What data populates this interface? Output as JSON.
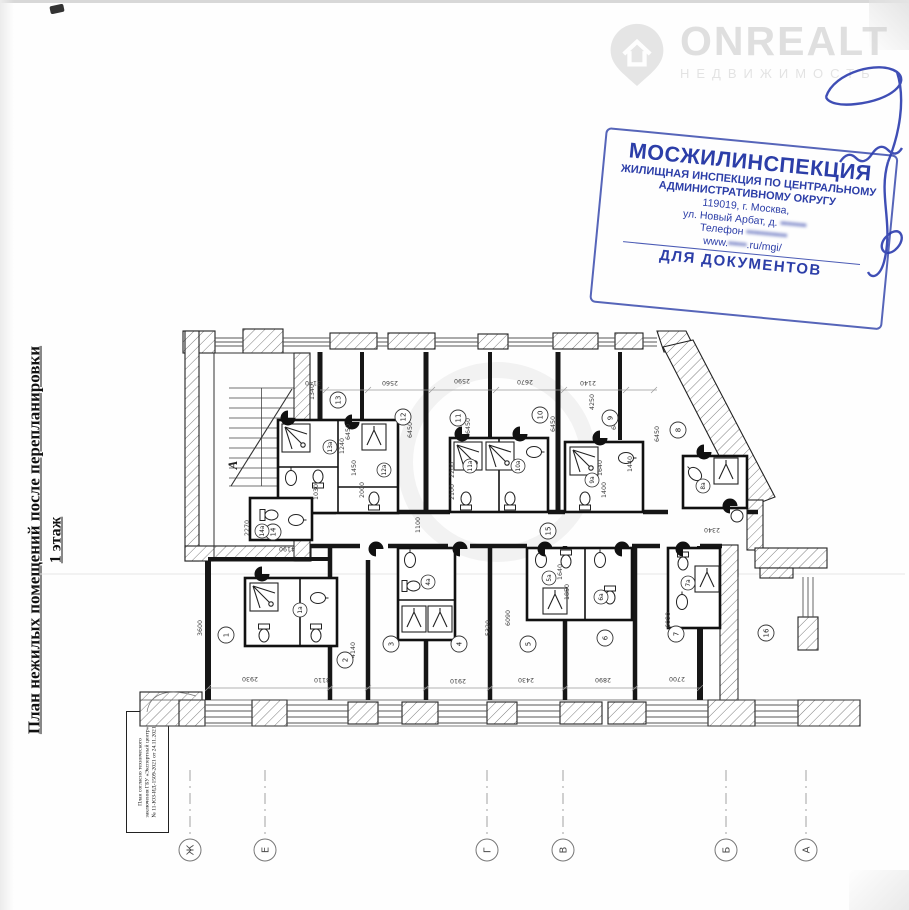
{
  "watermark": {
    "brand": "ONREALT",
    "subtitle": "НЕДВИЖИМОСТЬ"
  },
  "stamp": {
    "color": "#2c3ea8",
    "org": "МОСЖИЛИНСПЕКЦИЯ",
    "line1": "ЖИЛИЩНАЯ ИНСПЕКЦИЯ ПО ЦЕНТРАЛЬНОМУ",
    "line2": "АДМИНИСТРАТИВНОМУ ОКРУГУ",
    "addr1": "119019, г. Москва,",
    "addr2_label": "ул. Новый Арбат, д. ",
    "addr2_blur": "▪▪▪▪▪▪▪",
    "addr3_label": "Телефон",
    "addr3_blur": " ▪▪▪▪▪▪▪▪▪▪▪",
    "addr4_pre": "www.",
    "addr4_blur": "▪▪▪▪▪",
    "addr4_post": ".ru/mgi/",
    "footer": "ДЛЯ ДОКУМЕНТОВ"
  },
  "side_caption": {
    "title": "План нежилых помещений после перепланировки",
    "subtitle": "1 этаж"
  },
  "note_box": {
    "line1": "План согласно технического",
    "line2": "заключения ГБУ «Экспертный центр»",
    "line3": "№ 11-ЮЗ-ИД-1509-2021 от 24.11.2021"
  },
  "plan": {
    "stair_label": "А",
    "rooms": [
      {
        "n": "13",
        "x": 338,
        "y": 400
      },
      {
        "n": "12",
        "x": 403,
        "y": 417
      },
      {
        "n": "11",
        "x": 458,
        "y": 418
      },
      {
        "n": "10",
        "x": 540,
        "y": 415
      },
      {
        "n": "9",
        "x": 610,
        "y": 418
      },
      {
        "n": "8",
        "x": 678,
        "y": 430
      },
      {
        "n": "14",
        "x": 273,
        "y": 532
      },
      {
        "n": "15",
        "x": 548,
        "y": 531
      },
      {
        "n": "1",
        "x": 226,
        "y": 635
      },
      {
        "n": "2",
        "x": 345,
        "y": 660
      },
      {
        "n": "3",
        "x": 391,
        "y": 644
      },
      {
        "n": "4",
        "x": 459,
        "y": 644
      },
      {
        "n": "5",
        "x": 528,
        "y": 644
      },
      {
        "n": "6",
        "x": 605,
        "y": 638
      },
      {
        "n": "7",
        "x": 676,
        "y": 634
      },
      {
        "n": "16",
        "x": 766,
        "y": 633
      }
    ],
    "bath_rooms": [
      {
        "n": "13а",
        "x": 330,
        "y": 447
      },
      {
        "n": "12а",
        "x": 384,
        "y": 470
      },
      {
        "n": "14а",
        "x": 262,
        "y": 531
      },
      {
        "n": "11а",
        "x": 470,
        "y": 466
      },
      {
        "n": "10а",
        "x": 518,
        "y": 466
      },
      {
        "n": "9а",
        "x": 592,
        "y": 480
      },
      {
        "n": "8а",
        "x": 703,
        "y": 486
      },
      {
        "n": "1а",
        "x": 300,
        "y": 610
      },
      {
        "n": "4а",
        "x": 428,
        "y": 582
      },
      {
        "n": "5а",
        "x": 549,
        "y": 578
      },
      {
        "n": "6а",
        "x": 601,
        "y": 597
      },
      {
        "n": "7а",
        "x": 688,
        "y": 583
      }
    ],
    "dims": [
      [
        "3140",
        313,
        383,
        180
      ],
      [
        "2560",
        390,
        383,
        180
      ],
      [
        "2590",
        462,
        381,
        180
      ],
      [
        "2670",
        525,
        382,
        180
      ],
      [
        "2140",
        588,
        383,
        180
      ],
      [
        "1340",
        312,
        392,
        -90
      ],
      [
        "6450",
        348,
        432,
        -90
      ],
      [
        "6450",
        410,
        430,
        -90
      ],
      [
        "6450",
        468,
        426,
        -90
      ],
      [
        "6450",
        553,
        424,
        -90
      ],
      [
        "6450",
        614,
        422,
        -90
      ],
      [
        "6450",
        657,
        434,
        -90
      ],
      [
        "4250",
        592,
        402,
        -90
      ],
      [
        "1440",
        630,
        464,
        -90
      ],
      [
        "2270",
        247,
        528,
        -90
      ],
      [
        "4190",
        287,
        549,
        180
      ],
      [
        "1100",
        418,
        525,
        -90
      ],
      [
        "2340",
        712,
        530,
        180
      ],
      [
        "3600",
        200,
        628,
        -90
      ],
      [
        "4140",
        353,
        650,
        -90
      ],
      [
        "5320",
        488,
        628,
        -90
      ],
      [
        "6090",
        508,
        618,
        -90
      ],
      [
        "6090",
        668,
        620,
        -90
      ],
      [
        "2930",
        250,
        679,
        180
      ],
      [
        "3110",
        322,
        680,
        180
      ],
      [
        "2910",
        458,
        681,
        180
      ],
      [
        "2430",
        526,
        680,
        180
      ],
      [
        "2890",
        603,
        680,
        180
      ],
      [
        "2700",
        677,
        679,
        180
      ],
      [
        "1240",
        342,
        446,
        -90
      ],
      [
        "1450",
        354,
        468,
        -90
      ],
      [
        "2000",
        362,
        490,
        -90
      ],
      [
        "1030",
        316,
        492,
        -90
      ],
      [
        "2200",
        452,
        470,
        -90
      ],
      [
        "2100",
        452,
        492,
        -90
      ],
      [
        "1640",
        600,
        468,
        -90
      ],
      [
        "1400",
        604,
        490,
        -90
      ],
      [
        "1640",
        560,
        572,
        -90
      ],
      [
        "1850",
        567,
        592,
        -90
      ]
    ],
    "axes": [
      {
        "l": "Ж",
        "x": 190
      },
      {
        "l": "Е",
        "x": 265
      },
      {
        "l": "Г",
        "x": 487
      },
      {
        "l": "В",
        "x": 563
      },
      {
        "l": "Б",
        "x": 726
      },
      {
        "l": "А",
        "x": 806
      }
    ],
    "axes_cy": 850
  }
}
